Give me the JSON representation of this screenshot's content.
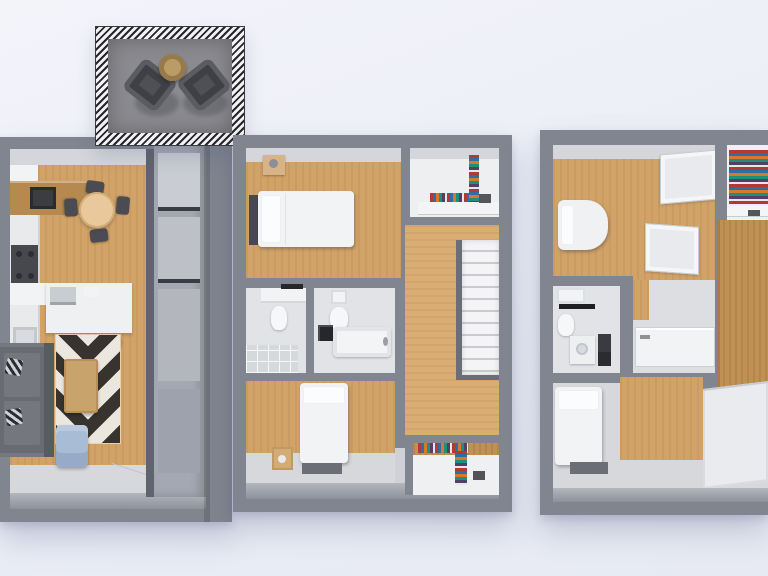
{
  "scene": {
    "description": "Top-down 3D dollhouse rendering of a three-level townhouse floor plan on a pale blue backdrop",
    "view": "top-down-3d",
    "text_visible": "none"
  },
  "palette": {
    "bg_top": "#f3f4fa",
    "bg_bottom": "#e9ecf5",
    "wall": "#80858f",
    "wall_dark": "#666b76",
    "wall_light": "#a9adb7",
    "wall_face": "#d5d6db",
    "wood": "#d2a368",
    "wood_dark": "#bf9154",
    "wood_light": "#d9ad74",
    "floor_gray": "#d6d8db",
    "floor_bath": "#e1e3e6",
    "white_obj": "#f2f3f4",
    "dark_obj": "#45474d",
    "deck": "#8a8a8f",
    "rug_dark": "#37342f",
    "rug_light": "#ece7de",
    "tan": "#d9b388",
    "table_wood": "#c9a36c",
    "blue_chair": "#a9bcd6"
  },
  "levels": [
    {
      "id": "level-1",
      "rooms": [
        {
          "name": "balcony-deck",
          "furniture": [
            "outdoor-armchair-left",
            "outdoor-armchair-right",
            "round-side-table"
          ]
        },
        {
          "name": "kitchen-dining",
          "furniture": [
            "fridge",
            "upper-cabinets",
            "range-hood",
            "counter",
            "stove",
            "sink",
            "kitchen-island",
            "island-appliance",
            "bar-stools-x3",
            "round-dining-table",
            "dining-chairs-x4"
          ]
        },
        {
          "name": "living-room",
          "furniture": [
            "sectional-sofa",
            "throw-pillows-x2",
            "chevron-rug",
            "coffee-table",
            "blue-lounge-chair"
          ]
        },
        {
          "name": "entry",
          "furniture": [
            "door-leaf"
          ]
        },
        {
          "name": "pantry-shelving",
          "furniture": [
            "tall-gray-cabinet"
          ]
        }
      ]
    },
    {
      "id": "level-2",
      "rooms": [
        {
          "name": "bedroom-front",
          "furniture": [
            "double-bed",
            "headboard",
            "nightstand"
          ]
        },
        {
          "name": "walk-in-closet-top",
          "furniture": [
            "clothes-stack",
            "hanging-clothes",
            "shelf"
          ]
        },
        {
          "name": "hallway-stairs",
          "furniture": [
            "staircase",
            "stair-railing"
          ]
        },
        {
          "name": "bathroom-left",
          "furniture": [
            "sink-counter",
            "toilet",
            "shower-tile-floor",
            "towel-bar"
          ]
        },
        {
          "name": "bathroom-right",
          "furniture": [
            "sink",
            "toilet",
            "laundry-box",
            "bathtub"
          ]
        },
        {
          "name": "bedroom-back",
          "furniture": [
            "single-bed",
            "foot-mat",
            "wood-crate"
          ]
        },
        {
          "name": "walk-in-closet-bottom",
          "furniture": [
            "clothes-stack",
            "hanging-clothes"
          ]
        }
      ]
    },
    {
      "id": "level-3",
      "rooms": [
        {
          "name": "bedroom-front",
          "furniture": [
            "bed-rounded",
            "wardrobe-panel-upper",
            "wardrobe-panel-lower"
          ]
        },
        {
          "name": "closet-top-right",
          "furniture": [
            "clothes-stack",
            "shelf"
          ]
        },
        {
          "name": "wardrobe-room-right",
          "furniture": [
            "tall-wood-door",
            "wood-back-panel",
            "drawer-dresser"
          ]
        },
        {
          "name": "bathroom",
          "furniture": [
            "sink-top",
            "dark-counter",
            "toilet",
            "vanity-basin",
            "dark-shelf"
          ]
        },
        {
          "name": "shower-room",
          "furniture": [
            "shower-pan"
          ]
        },
        {
          "name": "bedroom-back",
          "furniture": [
            "single-bed",
            "foot-mat"
          ]
        }
      ]
    }
  ]
}
